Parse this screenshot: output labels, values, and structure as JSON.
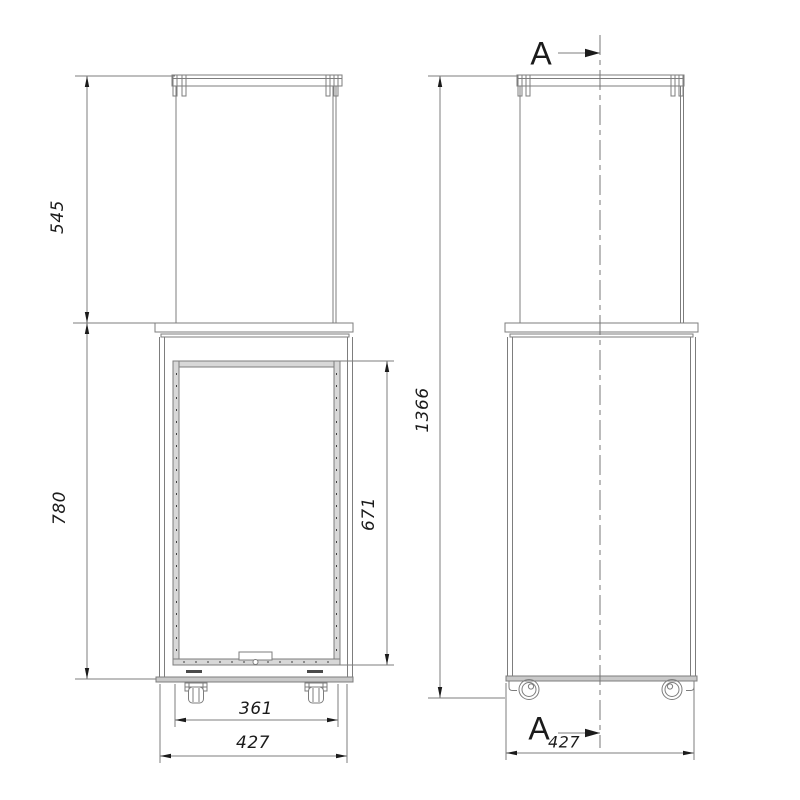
{
  "drawing": {
    "views": {
      "front": {
        "name": "front-view",
        "dims": {
          "glass_height": "545",
          "body_height": "780",
          "window_height": "671",
          "inner_width": "361",
          "outer_width": "427"
        }
      },
      "side": {
        "name": "side-view",
        "dims": {
          "total_height": "1366",
          "depth": "427"
        },
        "section": {
          "top_label": "A",
          "bottom_label": "A"
        }
      }
    },
    "colors": {
      "background": "#ffffff",
      "line": "#7d7d7d",
      "panel_fill": "#c9c9c9",
      "frame_fill": "#d8d8d8",
      "accent_text": "#1b1b1b"
    }
  }
}
